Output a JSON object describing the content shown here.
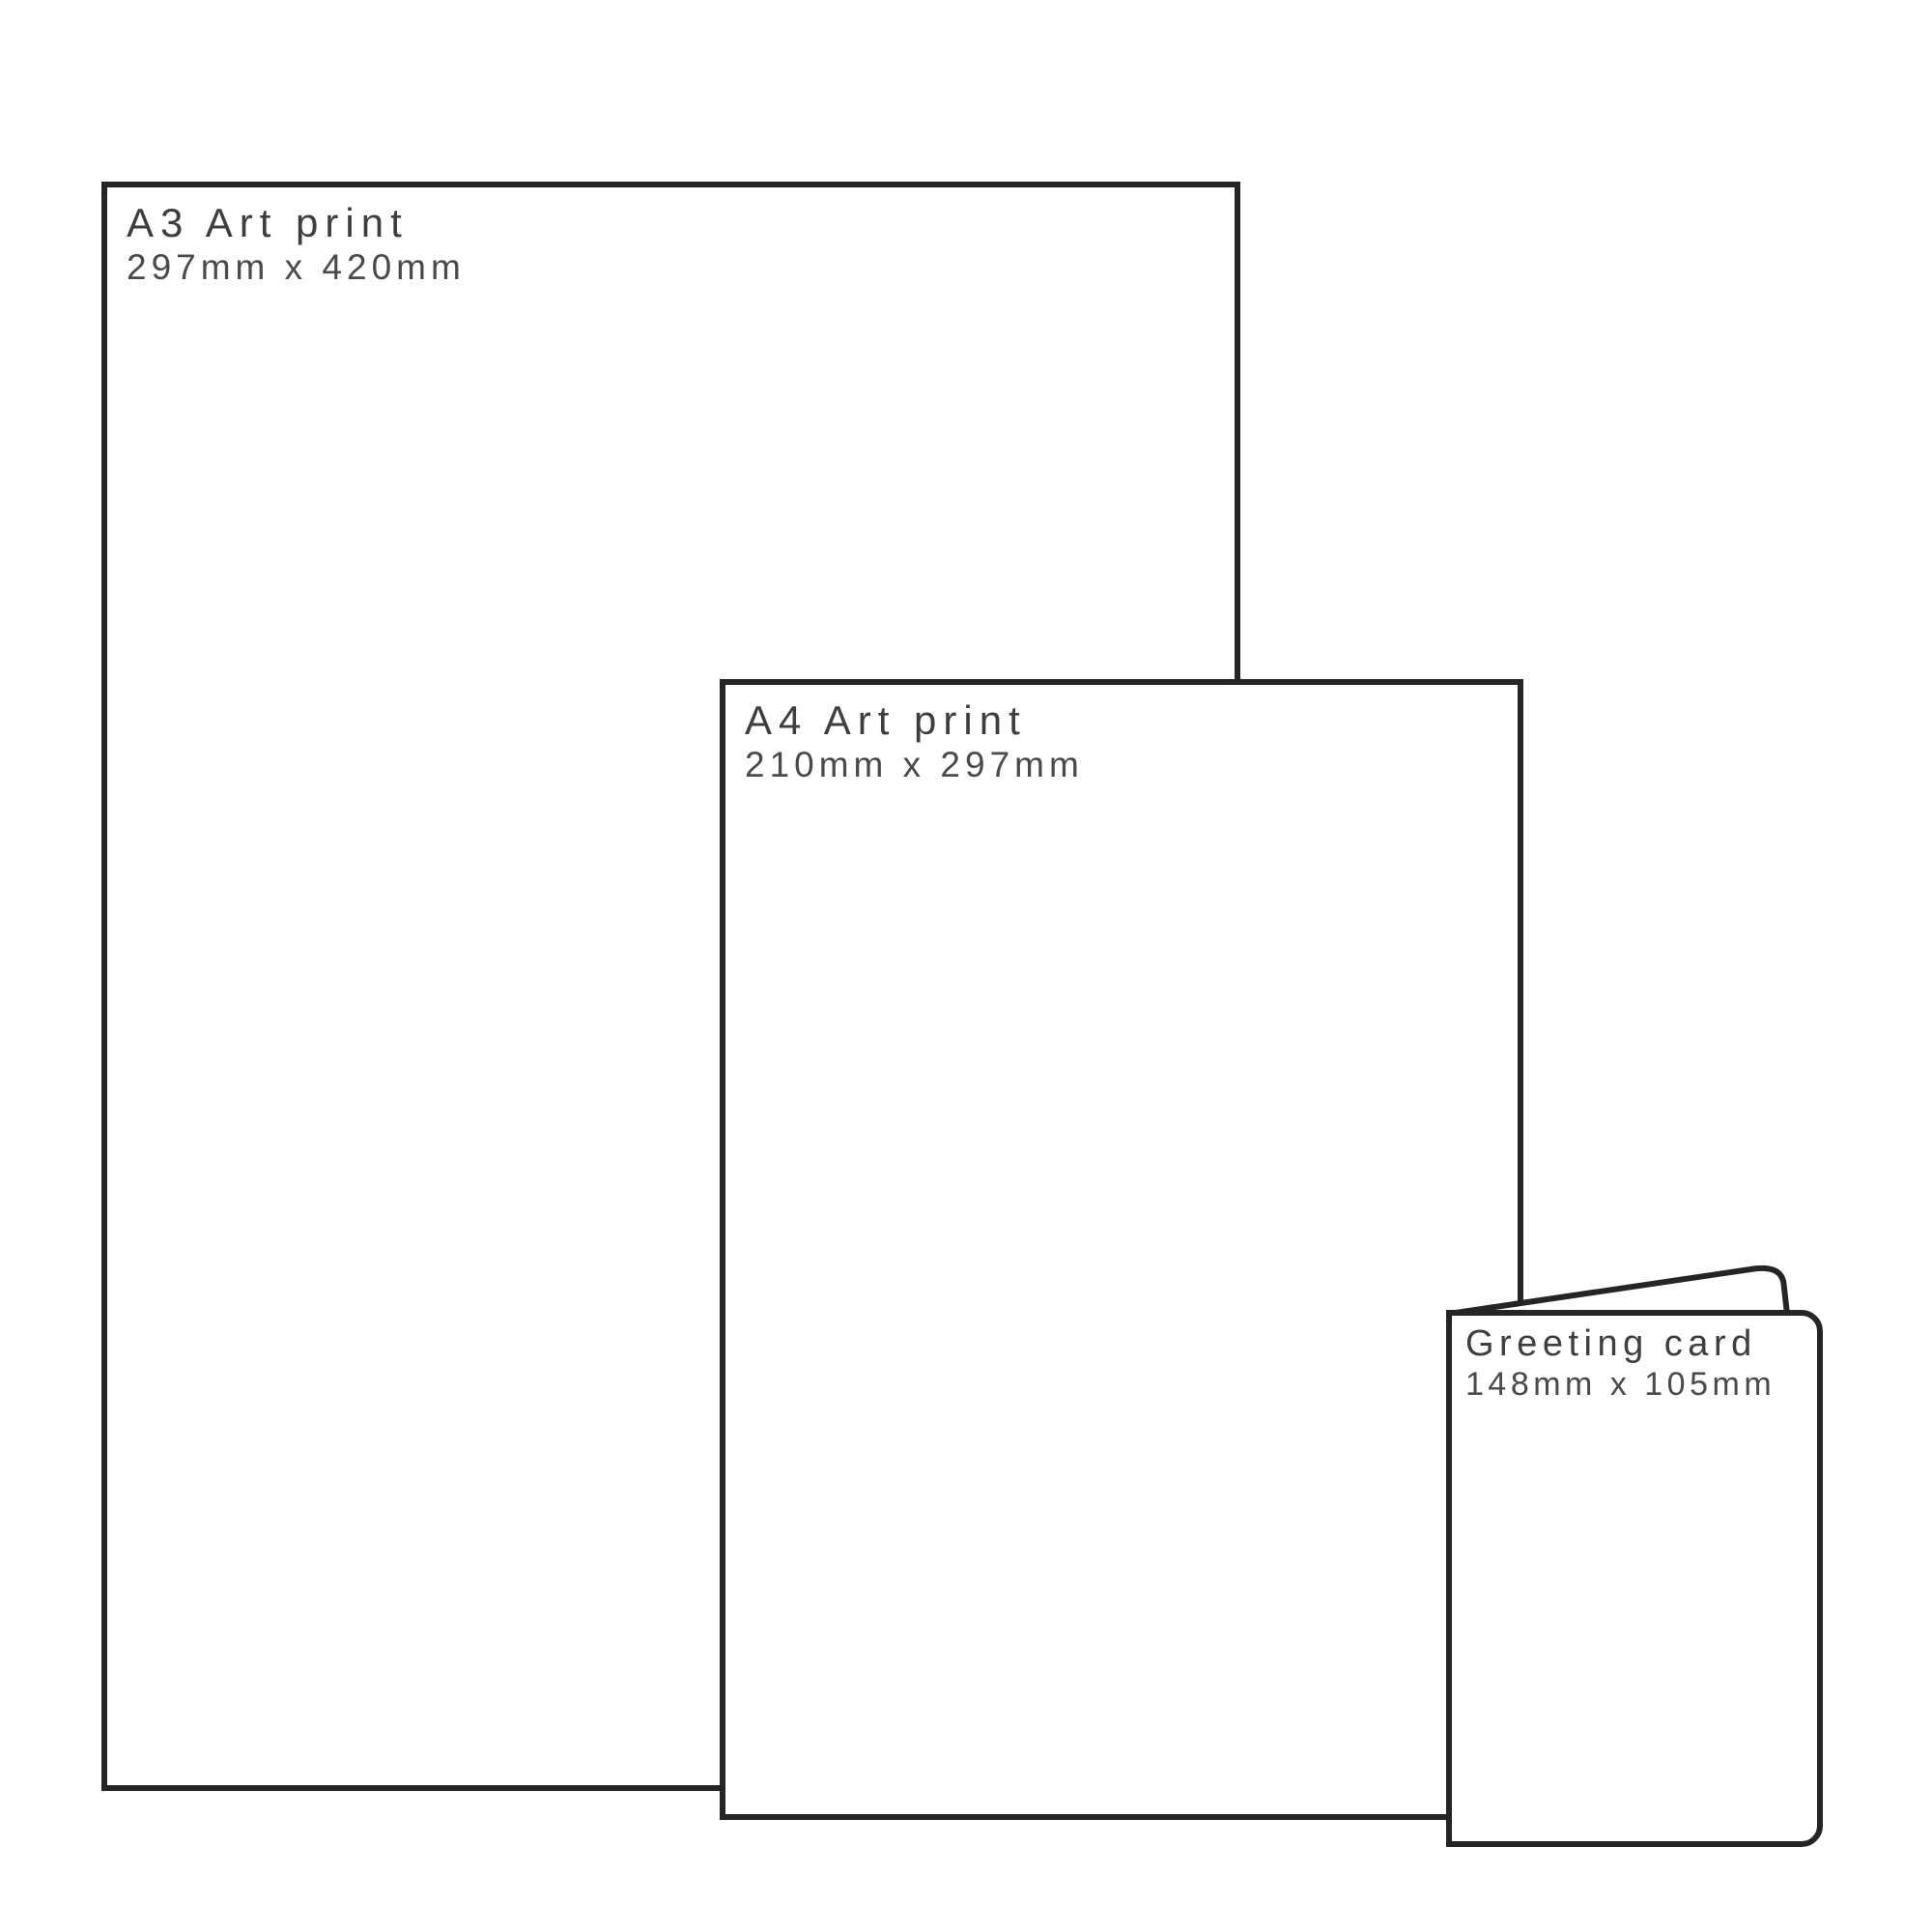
{
  "diagram": {
    "kind": "print-size-comparison",
    "background_color": "#ffffff",
    "outline_color": "#252526",
    "title_text_color": "#3e3e40",
    "dims_text_color": "#4a4a4c",
    "items": [
      {
        "id": "a3-art-print",
        "name": "A3 Art print",
        "dims": "297mm x 420mm"
      },
      {
        "id": "a4-art-print",
        "name": "A4 Art print",
        "dims": "210mm x 297mm"
      },
      {
        "id": "greeting-card",
        "name": "Greeting card",
        "dims": "148mm x 105mm"
      }
    ]
  }
}
